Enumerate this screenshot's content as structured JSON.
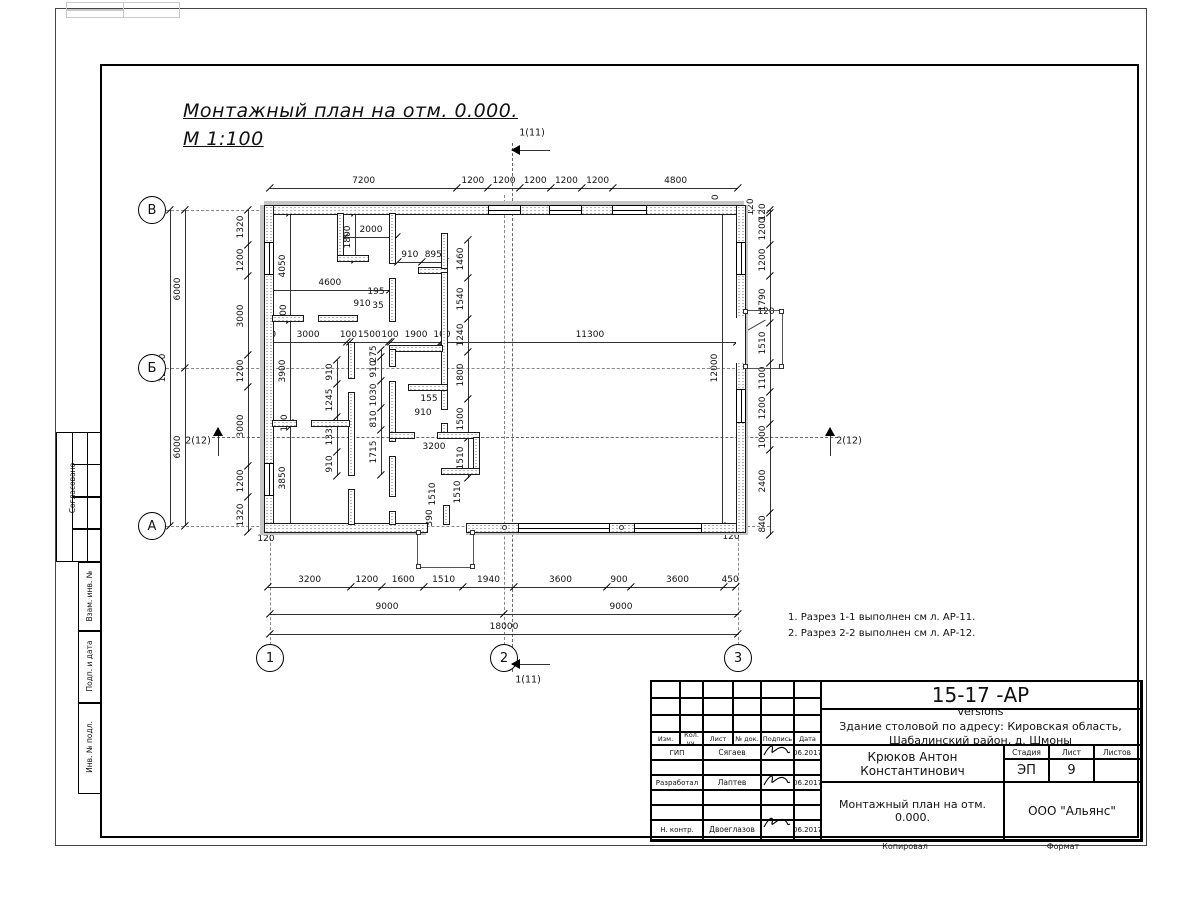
{
  "title": {
    "line1": "Монтажный план на отм. 0.000.",
    "line2": "М 1:100"
  },
  "notes": {
    "items": [
      "1. Разрез 1-1 выполнен см л. АР-11.",
      "2. Разрез 2-2 выполнен см л. АР-12."
    ]
  },
  "axes": {
    "rows": [
      {
        "label": "В",
        "y": 210
      },
      {
        "label": "Б",
        "y": 368
      },
      {
        "label": "А",
        "y": 526
      }
    ],
    "cols": [
      {
        "label": "1",
        "x": 270
      },
      {
        "label": "2",
        "x": 504
      },
      {
        "label": "3",
        "x": 738
      }
    ]
  },
  "sections": {
    "top": "1(11)",
    "bottom": "1(11)",
    "left": "2(12)",
    "right": "2(12)"
  },
  "scale": {
    "sx": 0.026,
    "sy": 0.0263
  },
  "chains": [
    {
      "dir": "h",
      "pos": 188,
      "start": 270,
      "segs": [
        7200,
        1200,
        1200,
        1200,
        1200,
        1200,
        4800
      ]
    },
    {
      "dir": "v",
      "pos": 248,
      "start": 210,
      "segs": [
        1320,
        1200,
        3000,
        1200,
        3000,
        1200,
        1320
      ]
    },
    {
      "dir": "v",
      "pos": 185,
      "start": 210,
      "segs": [
        6000,
        6000
      ]
    },
    {
      "dir": "v",
      "pos": 170,
      "start": 210,
      "segs": [
        12000
      ]
    },
    {
      "dir": "v",
      "pos": 770,
      "start": 210,
      "segs": [
        120,
        1200,
        1200,
        1790,
        1510,
        1100,
        1200,
        1000,
        2400,
        840
      ]
    },
    {
      "dir": "h",
      "pos": 587,
      "start": 268,
      "segs": [
        3200,
        1200,
        1600,
        1510,
        1940,
        3600,
        900,
        3600,
        450
      ]
    },
    {
      "dir": "h",
      "pos": 614,
      "start": 270,
      "segs": [
        9000,
        9000
      ]
    },
    {
      "dir": "h",
      "pos": 634,
      "start": 270,
      "segs": [
        18000
      ]
    },
    {
      "dir": "h",
      "pos": 342,
      "start": 266,
      "segs": [
        120,
        3000,
        100,
        1500,
        100,
        1900,
        100
      ]
    },
    {
      "dir": "h",
      "pos": 342,
      "start": 443,
      "segs": [
        11300
      ]
    },
    {
      "dir": "v",
      "pos": 337,
      "start": 360,
      "segs": [
        910,
        1245,
        1335,
        910
      ]
    },
    {
      "dir": "v",
      "pos": 381,
      "start": 350,
      "segs": [
        275,
        910,
        1030,
        810,
        1715
      ]
    },
    {
      "dir": "v",
      "pos": 468,
      "start": 240,
      "segs": [
        1460,
        1540,
        1240,
        1800,
        1500,
        1510
      ]
    },
    {
      "dir": "h",
      "pos": 262,
      "start": 398,
      "segs": [
        910,
        895
      ]
    },
    {
      "dir": "h",
      "pos": 237,
      "start": 345,
      "segs": [
        2000
      ]
    },
    {
      "dir": "v",
      "pos": 355,
      "start": 213,
      "segs": [
        1800
      ]
    },
    {
      "dir": "v",
      "pos": 290,
      "start": 213,
      "segs": [
        4050
      ]
    },
    {
      "dir": "h",
      "pos": 290,
      "start": 270,
      "segs": [
        4600
      ]
    },
    {
      "dir": "v",
      "pos": 290,
      "start": 320,
      "segs": [
        3900
      ]
    },
    {
      "dir": "v",
      "pos": 290,
      "start": 427,
      "segs": [
        3850
      ]
    },
    {
      "dir": "v",
      "pos": 722,
      "start": 210,
      "segs": [
        12000
      ]
    }
  ],
  "free_labels": [
    {
      "t": "120",
      "x": 716,
      "y": 203,
      "r": -90
    },
    {
      "t": "120",
      "x": 751,
      "y": 207,
      "r": -90
    },
    {
      "t": "120",
      "x": 266,
      "y": 539,
      "r": 0
    },
    {
      "t": "120",
      "x": 731,
      "y": 537,
      "r": 0
    },
    {
      "t": "100",
      "x": 284,
      "y": 313,
      "r": -90
    },
    {
      "t": "100",
      "x": 285,
      "y": 423,
      "r": -90
    },
    {
      "t": "195",
      "x": 376,
      "y": 292,
      "r": 0
    },
    {
      "t": "910",
      "x": 362,
      "y": 304,
      "r": 0
    },
    {
      "t": "35",
      "x": 378,
      "y": 306,
      "r": 0
    },
    {
      "t": "155",
      "x": 429,
      "y": 399,
      "r": 0
    },
    {
      "t": "910",
      "x": 423,
      "y": 413,
      "r": 0
    },
    {
      "t": "3200",
      "x": 434,
      "y": 447,
      "r": 0
    },
    {
      "t": "1510",
      "x": 433,
      "y": 494,
      "r": -90
    },
    {
      "t": "1510",
      "x": 458,
      "y": 492,
      "r": -90
    },
    {
      "t": "390",
      "x": 430,
      "y": 518,
      "r": -90
    }
  ],
  "leader": {
    "label": "120",
    "x": 766,
    "y": 312
  },
  "sidebar": {
    "items": [
      "Согласовано",
      "Взам. инв. №",
      "Подп. и дата",
      "Инв. № подл."
    ]
  },
  "titleblock": {
    "code": "15-17 -АР",
    "object_line1": "Здание столовой по адресу: Кировская область,",
    "object_line2": "Шабалинский район, д. Шмоны",
    "header": [
      "Изм.",
      "Кол. уч.",
      "Лист",
      "№ док.",
      "Подпись",
      "Дата"
    ],
    "rows": [
      {
        "role": "ГИП",
        "name": "Сягаев",
        "date": "06.2017"
      },
      {
        "role": "Разработал",
        "name": "Лаптев",
        "date": "06.2017"
      },
      {
        "role": "Н. контр.",
        "name": "Двоеглазов",
        "date": "06.2017"
      }
    ],
    "chief": "Крюков Антон Константинович",
    "stage_label": "Стадия",
    "sheet_label": "Лист",
    "sheets_label": "Листов",
    "stage": "ЭП",
    "sheet": "9",
    "sheets": "",
    "drawing_title": "Монтажный план на отм. 0.000.",
    "company": "ООО \"Альянс\""
  },
  "footer": {
    "copied": "Копировал",
    "format": "Формат"
  }
}
